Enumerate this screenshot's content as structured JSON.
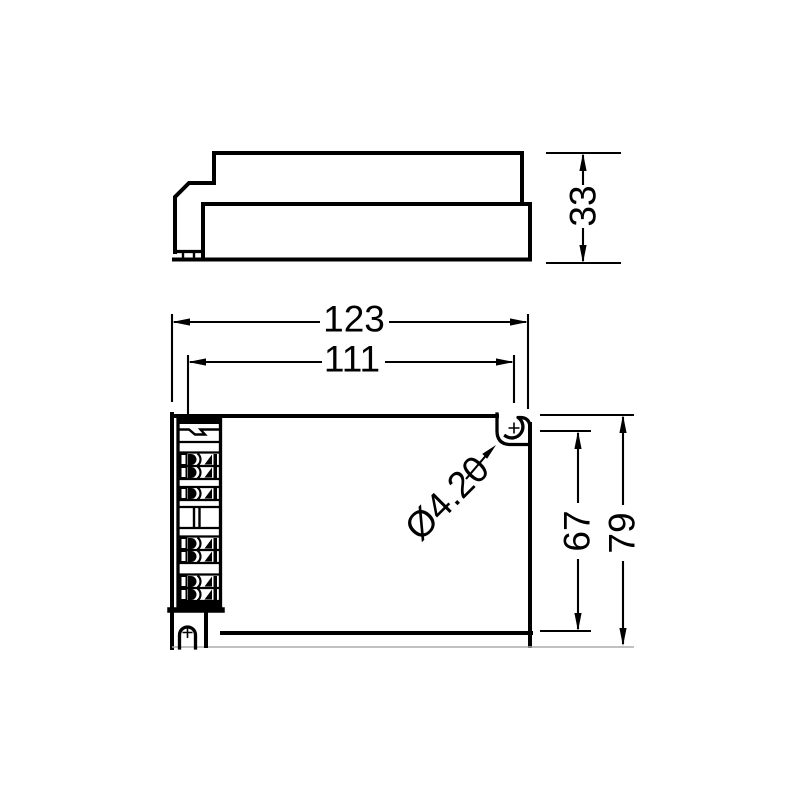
{
  "drawing": {
    "colors": {
      "line": "#000000",
      "background": "#ffffff",
      "thin_line": "#ababab"
    },
    "side_view": {
      "dims": {
        "height": "33"
      }
    },
    "bottom_view": {
      "dims": {
        "overall_width": "123",
        "hole_spacing_width": "111",
        "hole_spacing_height": "67",
        "overall_height": "79",
        "mounting_hole_diameter": "Ø4.20"
      }
    }
  }
}
